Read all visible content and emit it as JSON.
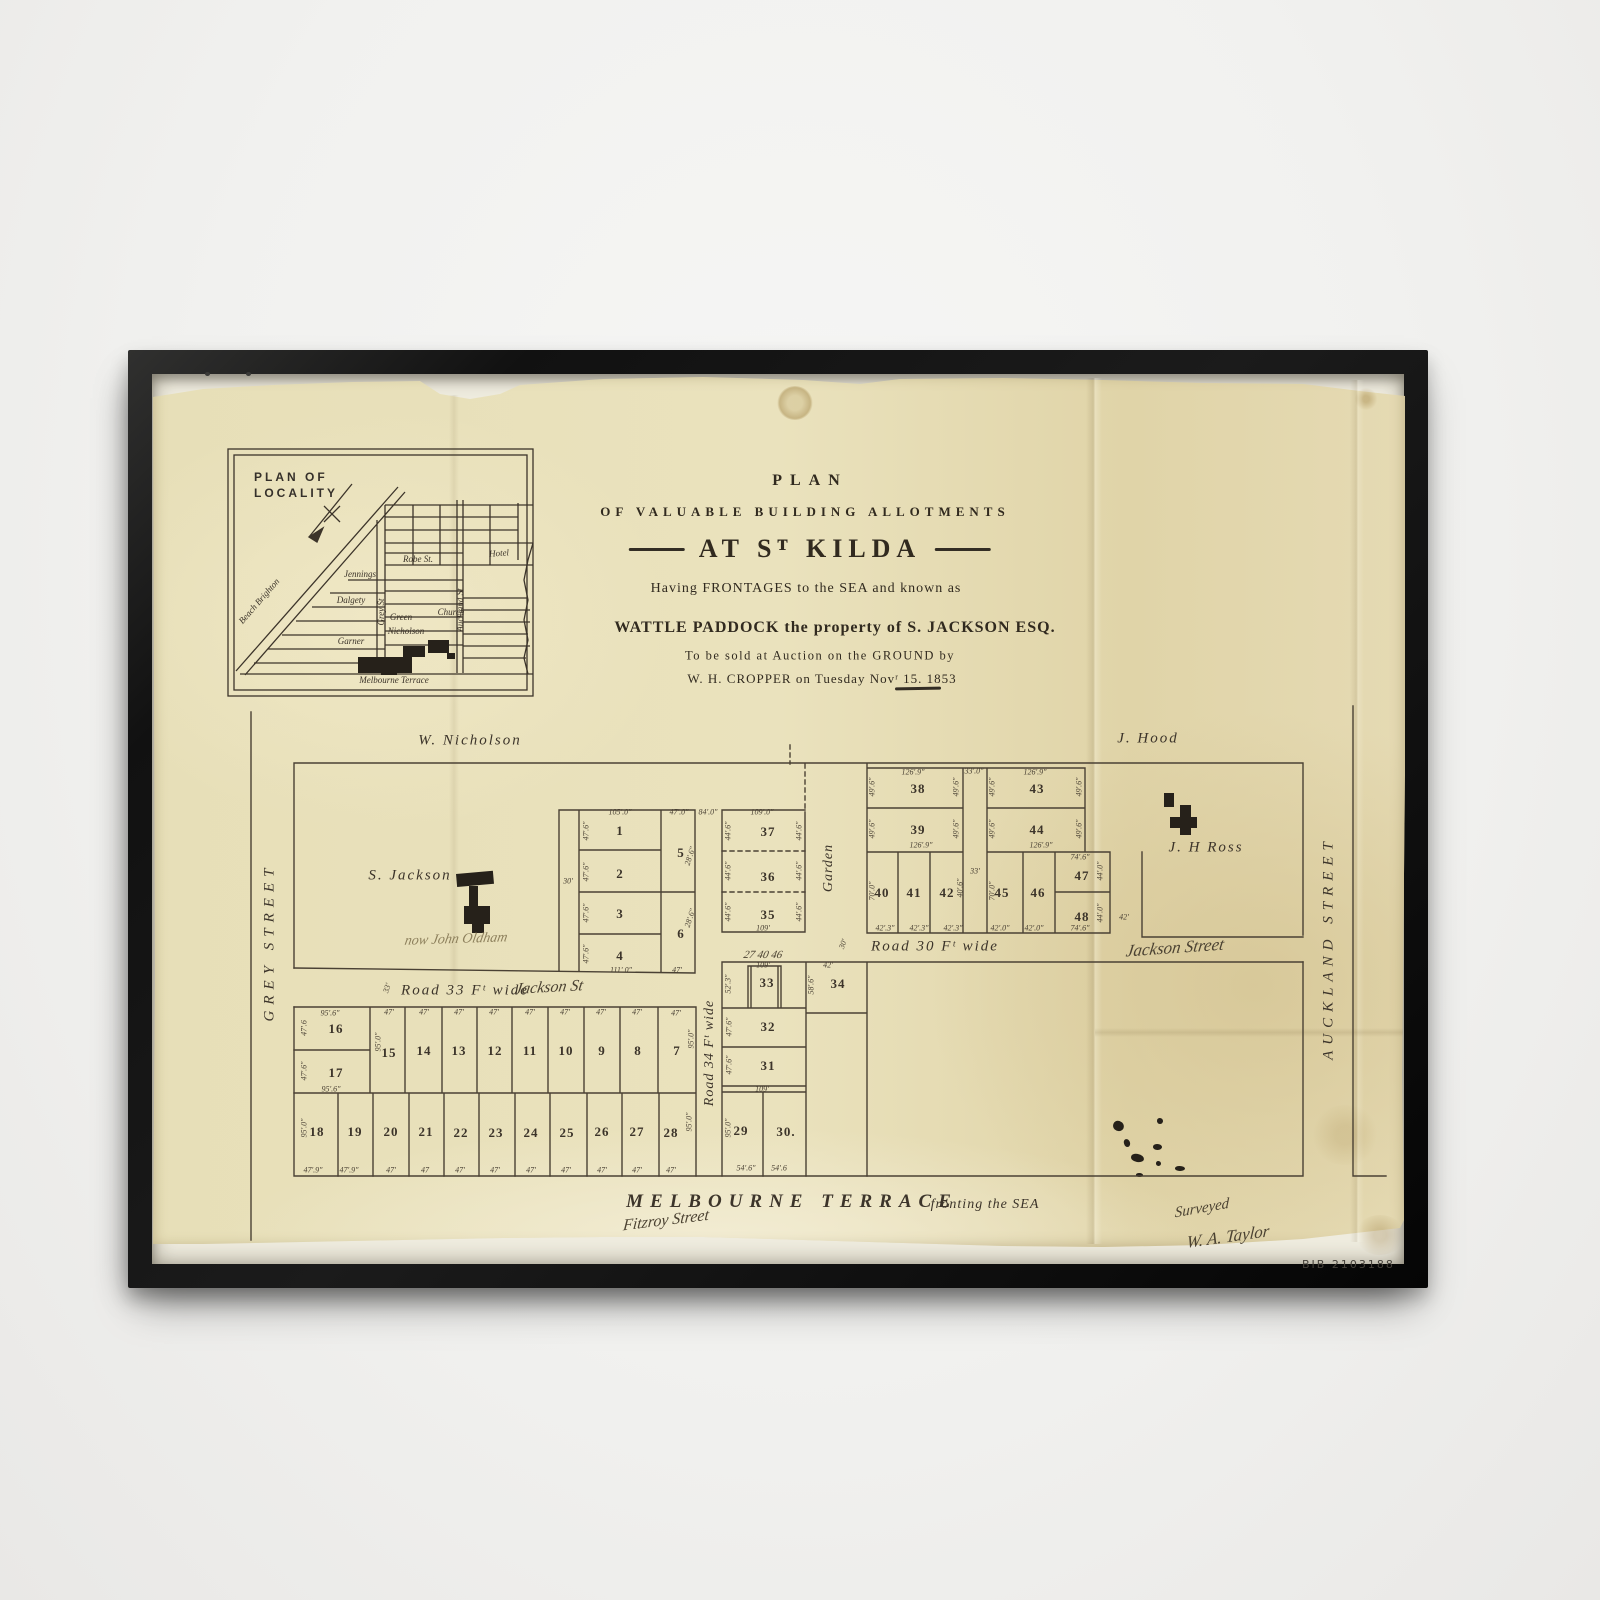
{
  "colors": {
    "paper": "#e8dfb8",
    "ink": "#3c342a",
    "frame": "#151515",
    "wall": "#f2f1ef"
  },
  "artwork": {
    "stamp": "BIB 2103188"
  },
  "title_block": {
    "line1": "PLAN",
    "line2": "OF VALUABLE BUILDING ALLOTMENTS",
    "line3": "AT Sᵀ KILDA",
    "line4": "Having FRONTAGES to the SEA and known as",
    "line5": "WATTLE PADDOCK the property of S. JACKSON ESQ.",
    "line6": "To be sold at Auction on the GROUND by",
    "line7": "W. H. CROPPER on Tuesday Novʳ 15. 1853"
  },
  "inset": {
    "heading_line1": "PLAN OF",
    "heading_line2": "LOCALITY",
    "streets": [
      [
        "Robe St.",
        418,
        559,
        0
      ],
      [
        "Jennings",
        360,
        574,
        0
      ],
      [
        "Dalgety",
        351,
        600,
        0
      ],
      [
        "Green",
        401,
        617,
        0
      ],
      [
        "Nicholson",
        406,
        631,
        0
      ],
      [
        "Garner",
        351,
        641,
        0
      ],
      [
        "Church",
        451,
        612,
        0
      ],
      [
        "Hotel",
        499,
        553,
        -4
      ],
      [
        "Melbourne Terrace",
        394,
        680,
        0
      ],
      [
        "Grey St",
        381,
        612,
        -90
      ],
      [
        "Auckland St",
        460,
        610,
        -90
      ],
      [
        "Beach Brighton",
        259,
        601,
        -49
      ]
    ]
  },
  "plan": {
    "street_labels": [
      {
        "id": "grey-street",
        "t": "GREY STREET",
        "x": 270,
        "y": 942,
        "r": -90,
        "cls": "street-v"
      },
      {
        "id": "auckland-street",
        "t": "AUCKLAND STREET",
        "x": 1329,
        "y": 948,
        "r": -90,
        "cls": "street-v"
      },
      {
        "id": "w-nicholson",
        "t": "W. Nicholson",
        "x": 470,
        "y": 741,
        "r": 0,
        "cls": "street"
      },
      {
        "id": "j-hood",
        "t": "J. Hood",
        "x": 1148,
        "y": 739,
        "r": 0,
        "cls": "street"
      },
      {
        "id": "road-33",
        "t": "Road 33 Fᵗ wide",
        "x": 465,
        "y": 991,
        "r": 0,
        "cls": "street"
      },
      {
        "id": "road-30",
        "t": "Road 30 Fᵗ wide",
        "x": 935,
        "y": 947,
        "r": 0,
        "cls": "street"
      },
      {
        "id": "road-34",
        "t": "Road 34 Fᵗ wide",
        "x": 710,
        "y": 1053,
        "r": -90,
        "cls": "street-sub"
      },
      {
        "id": "garden",
        "t": "Garden",
        "x": 829,
        "y": 868,
        "r": -90,
        "cls": "street-sub"
      },
      {
        "id": "melbourne-terrace",
        "t": "MELBOURNE  TERRACE",
        "x": 792,
        "y": 1202,
        "r": 0,
        "cls": "street-big"
      },
      {
        "id": "fronting-the-sea",
        "t": "fronting the SEA",
        "x": 985,
        "y": 1205,
        "r": 0,
        "cls": "street-sub"
      }
    ],
    "owner_labels": [
      {
        "id": "s-jackson",
        "t": "S. Jackson",
        "x": 410,
        "y": 876
      },
      {
        "id": "j-h-ross",
        "t": "J. H Ross",
        "x": 1206,
        "y": 848
      }
    ],
    "handwriting": [
      {
        "t": "Jackson St",
        "x": 549,
        "y": 988,
        "r": -3,
        "s": 16
      },
      {
        "t": "Jackson Street",
        "x": 1175,
        "y": 948,
        "r": -4,
        "s": 17
      },
      {
        "t": "now John Oldham",
        "x": 456,
        "y": 940,
        "r": -2,
        "s": 14,
        "f": 1
      },
      {
        "t": "Fitzroy Street",
        "x": 666,
        "y": 1221,
        "r": -7,
        "s": 16
      },
      {
        "t": "Surveyed",
        "x": 1202,
        "y": 1209,
        "r": -10,
        "s": 15
      },
      {
        "t": "W. A. Taylor",
        "x": 1228,
        "y": 1237,
        "r": -8,
        "s": 17
      },
      {
        "t": "27   40   46",
        "x": 763,
        "y": 955,
        "r": 0,
        "s": 11
      }
    ],
    "lots": [
      [
        "1",
        620,
        831
      ],
      [
        "2",
        620,
        874
      ],
      [
        "3",
        620,
        914
      ],
      [
        "4",
        620,
        956
      ],
      [
        "5",
        681,
        853
      ],
      [
        "6",
        681,
        934
      ],
      [
        "7",
        677,
        1051
      ],
      [
        "8",
        638,
        1051
      ],
      [
        "9",
        602,
        1051
      ],
      [
        "10",
        566,
        1051
      ],
      [
        "11",
        530,
        1051
      ],
      [
        "12",
        495,
        1051
      ],
      [
        "13",
        459,
        1051
      ],
      [
        "14",
        424,
        1051
      ],
      [
        "15",
        389,
        1053
      ],
      [
        "16",
        336,
        1029
      ],
      [
        "17",
        336,
        1073
      ],
      [
        "18",
        317,
        1132
      ],
      [
        "19",
        355,
        1132
      ],
      [
        "20",
        391,
        1132
      ],
      [
        "21",
        426,
        1132
      ],
      [
        "22",
        461,
        1133
      ],
      [
        "23",
        496,
        1133
      ],
      [
        "24",
        531,
        1133
      ],
      [
        "25",
        567,
        1133
      ],
      [
        "26",
        602,
        1132
      ],
      [
        "27",
        637,
        1132
      ],
      [
        "28",
        671,
        1133
      ],
      [
        "29",
        741,
        1131
      ],
      [
        "30.",
        786,
        1132
      ],
      [
        "31",
        768,
        1066
      ],
      [
        "32",
        768,
        1027
      ],
      [
        "33",
        767,
        983
      ],
      [
        "34",
        838,
        984
      ],
      [
        "35",
        768,
        915
      ],
      [
        "36",
        768,
        877
      ],
      [
        "37",
        768,
        832
      ],
      [
        "38",
        918,
        789
      ],
      [
        "39",
        918,
        830
      ],
      [
        "40",
        882,
        893
      ],
      [
        "41",
        914,
        893
      ],
      [
        "42",
        947,
        893
      ],
      [
        "43",
        1037,
        789
      ],
      [
        "44",
        1037,
        830
      ],
      [
        "45",
        1002,
        893
      ],
      [
        "46",
        1038,
        893
      ],
      [
        "47",
        1082,
        876
      ],
      [
        "48",
        1082,
        917
      ]
    ],
    "dims": [
      [
        "105'.0\"",
        620,
        812,
        0
      ],
      [
        "47'.0\"",
        679,
        812,
        0
      ],
      [
        "84'.0\"",
        708,
        812,
        0
      ],
      [
        "109'.0\"",
        762,
        812,
        0
      ],
      [
        "47'.6\"",
        586,
        831,
        -90
      ],
      [
        "47'.6\"",
        586,
        872,
        -90
      ],
      [
        "47'.6\"",
        586,
        913,
        -90
      ],
      [
        "47'.6\"",
        586,
        954,
        -90
      ],
      [
        "30'",
        568,
        881,
        0
      ],
      [
        "28'.6\"",
        690,
        856,
        -72
      ],
      [
        "28'.6\"",
        690,
        918,
        -72
      ],
      [
        "111'.0\"",
        621,
        970,
        0
      ],
      [
        "47'",
        677,
        970,
        0
      ],
      [
        "44'.6\"",
        728,
        831,
        -90
      ],
      [
        "44'.6\"",
        728,
        871,
        -90
      ],
      [
        "44'.6\"",
        728,
        912,
        -90
      ],
      [
        "44'.6\"",
        799,
        831,
        -90
      ],
      [
        "44'.6\"",
        799,
        871,
        -90
      ],
      [
        "44'.6\"",
        799,
        912,
        -90
      ],
      [
        "109'",
        763,
        928,
        0
      ],
      [
        "126'.9\"",
        913,
        772,
        0
      ],
      [
        "49'.6\"",
        872,
        787,
        -90
      ],
      [
        "49'.6\"",
        956,
        787,
        -90
      ],
      [
        "49'.6\"",
        872,
        829,
        -90
      ],
      [
        "49'.6\"",
        956,
        829,
        -90
      ],
      [
        "126'.9\"",
        921,
        845,
        0
      ],
      [
        "33'.0\"",
        974,
        771,
        0
      ],
      [
        "33'",
        975,
        871,
        0
      ],
      [
        "126'.9\"",
        1035,
        772,
        0
      ],
      [
        "49'.6\"",
        992,
        787,
        -90
      ],
      [
        "49'.6\"",
        1079,
        787,
        -90
      ],
      [
        "49'.6\"",
        992,
        829,
        -90
      ],
      [
        "49'.6\"",
        1079,
        829,
        -90
      ],
      [
        "126'.9\"",
        1041,
        845,
        0
      ],
      [
        "70'.0\"",
        872,
        891,
        -90
      ],
      [
        "40'.6\"",
        960,
        888,
        -90
      ],
      [
        "42'.3\"",
        885,
        928,
        0
      ],
      [
        "42'.3\"",
        919,
        928,
        0
      ],
      [
        "42'.3\"",
        953,
        928,
        0
      ],
      [
        "70'.0\"",
        992,
        891,
        -90
      ],
      [
        "42'.0\"",
        1000,
        928,
        0
      ],
      [
        "42'.0\"",
        1034,
        928,
        0
      ],
      [
        "74'.6\"",
        1080,
        857,
        0
      ],
      [
        "44'.0\"",
        1100,
        871,
        -90
      ],
      [
        "74'.6\"",
        1080,
        928,
        0
      ],
      [
        "44'.0\"",
        1100,
        913,
        -90
      ],
      [
        "42'",
        1124,
        917,
        0
      ],
      [
        "30'",
        843,
        944,
        -70
      ],
      [
        "109'",
        763,
        965,
        0
      ],
      [
        "52'.3\"",
        728,
        984,
        -90
      ],
      [
        "42'",
        828,
        965,
        0
      ],
      [
        "58'.6\"",
        811,
        985,
        -90
      ],
      [
        "47'.6\"",
        729,
        1027,
        -90
      ],
      [
        "47'.6\"",
        729,
        1065,
        -90
      ],
      [
        "109'",
        762,
        1089,
        0
      ],
      [
        "95'.0\"",
        728,
        1128,
        -90
      ],
      [
        "54'.6\"",
        746,
        1168,
        0
      ],
      [
        "54'.6",
        779,
        1168,
        0
      ],
      [
        "95'.6\"",
        330,
        1013,
        0
      ],
      [
        "47'.6",
        304,
        1028,
        -90
      ],
      [
        "47'.6\"",
        304,
        1071,
        -90
      ],
      [
        "95'.6\"",
        331,
        1089,
        0
      ],
      [
        "95'.0\"",
        378,
        1042,
        -90
      ],
      [
        "47'",
        389,
        1012,
        0
      ],
      [
        "47'",
        424,
        1012,
        0
      ],
      [
        "47'",
        459,
        1012,
        0
      ],
      [
        "47'",
        494,
        1012,
        0
      ],
      [
        "47'",
        530,
        1012,
        0
      ],
      [
        "47'",
        565,
        1012,
        0
      ],
      [
        "47'",
        601,
        1012,
        0
      ],
      [
        "47'",
        637,
        1012,
        0
      ],
      [
        "47'",
        676,
        1013,
        0
      ],
      [
        "95'.0\"",
        691,
        1039,
        -90
      ],
      [
        "95'.0\"",
        304,
        1128,
        -90
      ],
      [
        "95'.0\"",
        689,
        1122,
        -90
      ],
      [
        "47'.9\"",
        313,
        1170,
        0
      ],
      [
        "47'.9\"",
        349,
        1170,
        0
      ],
      [
        "47'",
        391,
        1170,
        0
      ],
      [
        "47",
        425,
        1170,
        0
      ],
      [
        "47'",
        460,
        1170,
        0
      ],
      [
        "47'",
        495,
        1170,
        0
      ],
      [
        "47'",
        531,
        1170,
        0
      ],
      [
        "47'",
        566,
        1170,
        0
      ],
      [
        "47'",
        602,
        1170,
        0
      ],
      [
        "47'",
        637,
        1170,
        0
      ],
      [
        "47'",
        671,
        1170,
        0
      ],
      [
        "33'",
        387,
        988,
        -72
      ]
    ]
  }
}
